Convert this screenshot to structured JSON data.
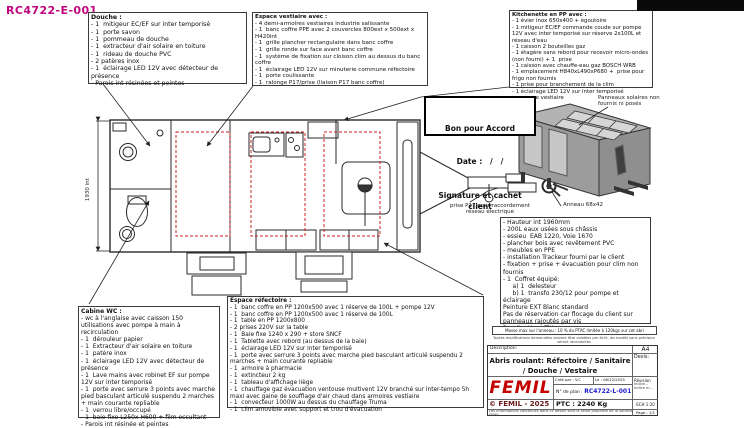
{
  "sheet_ref": "RC4722-E-001",
  "colors": {
    "ref_magenta": "#c0067c",
    "plan_number_blue": "#1a1acc",
    "logo_red": "#c40000",
    "copyright_red": "#6b1a1a",
    "highlight_red_dash": "#cc2222",
    "trailer_gray": "#9c9c9c"
  },
  "panels": {
    "douche": {
      "title": "Douche :",
      "items": [
        "- 1  mitigeur EC/EF sur inter temporisé",
        "- 1  porte savon",
        "- 1  pommeau de douche",
        "- 1  extracteur d'air solaire en toiture",
        "- 1  rideau de douche PVC",
        "- 2 patères inox",
        "- 1  éclairage LED 12V avec détecteur de présence",
        "- Parois int résinées et peintes"
      ]
    },
    "vestiaire": {
      "title": "Espace vestiaire avec :",
      "items": [
        "- 4 demi-armoires vestiaires industrie salissante",
        "- 1  banc coffre PPE avec 2 couvercles 800ext x 500ext x H420int",
        "- 1  grille plancher rectangulaire dans banc coffre",
        "- 1  grille ronde sur face avant banc coffre",
        "- 1  système de fixation sur cloison clim au dessus du banc coffre",
        "- 1  éclairage LED 12V sur minuterie commune réfectoire",
        "- 1  porte coulissante",
        "- 1  ralonge P17/prise (liaison P17 banc coffre)"
      ]
    },
    "kitchenette": {
      "title": "Kitchenette en PP avec :",
      "items": [
        "- 1 évier inox 650x400 + égoutoire",
        "- 1 mitigeur EC/EF commande coude sur pompe 12V avec inter temporisé sur réserve 2x100L et réseau d'eau",
        "- 1 caisson 2 bouteilles gaz",
        "- 1 étagère sans rebord pour recevoir micro-ondes (non fourni) + 1  prise",
        "- 1 caisson avec chauffe-eau gaz BOSCH WRB",
        "- 1 emplacement H840xL490xP680 +  prise pour frigo non fournis",
        "- 1 prise pour branchement de la clim",
        "- 1 éclairage LED 12V sur inter temporisé commune vestiaire"
      ]
    },
    "cabine_wc": {
      "title": "Cabine WC :",
      "items": [
        "- wc à l'anglaise avec caisson 150 utilisations avec pompe à main à recirculation",
        "- 1  dérouleur papier",
        "- 1  Extracteur d'air solaire en toiture",
        "- 1  patère inox",
        "- 1  éclairage LED 12V avec détecteur de présence",
        "- 1  Lave mains avec robinet EF sur pompe 12V sur inter temporisé",
        "- 1  porte avec serrure 3 points avec marche pied basculant articulé suspendu 2 marches + main courante repliable",
        "- 1  verrou libre/occupé",
        "- 1  baie fixe L250x H600 + film occultant",
        "- Parois int résinée et peintes"
      ]
    },
    "refectoire": {
      "title": "Espace réfectoire :",
      "items": [
        "- 1  banc coffre en PP 1200x500 avec 1 réserve de 100L + pompe 12V",
        "- 1  banc coffre en PP 1200x500 avec 1 réserve de 100L",
        "- 1  table en PP 1200x800",
        "- 2 prises 220V sur la table",
        "- 1  Baie fixe 1240 x 290 + store SNCF",
        "- 1  Tablette avec rebord (au dessus de la baie)",
        "- 1  éclairage LED 12V sur inter temporisé",
        "- 1  porte avec serrure 3 points avec marche pied basculant articulé suspendu 2 marches + main courante repliable",
        "- 1  armoire à pharmacie",
        "- 1  extincteur 2 kg",
        "- 1  tableau d'affichage liège",
        "- 1  chauffage gaz évacuation ventouse multivent 12V branché sur inter-tempo 5h maxi avec gaine de soufflage d'air chaud dans armoires vestiaire",
        "- 1  convecteur 1000W au dessus du chauffage Truma",
        "- 1  clim amovible avec support et trou d'évacuation"
      ]
    },
    "specs": {
      "items": [
        "- Hauteur int 1960mm",
        "- 200L eaux usées sous châssis",
        "- essieu  EAB 1220, Voie 1670",
        "- plancher bois avec revêtement PVC",
        "- meubles en PPE",
        "- installation Trackeur fourni par le client",
        "- fixation + prise + évacuation pour clim non fournis",
        "- 1  Coffret équipé:",
        "     a) 1  delesteur",
        "     b) 1  transfo 230/12 pour pompe et éclairage",
        "Peinture EXT Blanc standard",
        "Pas de réservation car flocage du client sur panneaux rajoutés par vis",
        "Pas d'anti graffiti"
      ]
    }
  },
  "approval_box": {
    "line1": "Bon pour Accord",
    "line2": "Date :   /   /",
    "line3": "Signature et cachet client"
  },
  "annotations": {
    "solar_panels": "Panneaux solaires non fournis ni posés",
    "ring": "Anneau 68x42",
    "p17_plug": "prise P17  pour raccordement réseau électrique",
    "interior_height_dim": "1930 int"
  },
  "strips": {
    "masse_note": "Masse max sur l'anneau : 10 % du PTAC limitée à 120kgs sur cet abri",
    "fine_print": "Toutes modifications demandées doivent être validées par écrit, les modifs sans précision seront reconduites"
  },
  "title_block": {
    "description_label": "Description:",
    "description": "Abris roulant: Réfectoire / Sanitaire / Douche / Vestaire",
    "format": "A4",
    "devis_label": "Devis:",
    "logo": "FEMIL",
    "created_by": "Créé par : V.C",
    "date": "Le : 06/12/2025",
    "revision_label": "Révision",
    "revision_line1": "Indice...",
    "revision_line2": "Indice m...",
    "plan_label": "N° de plan : ",
    "plan_number": "RC4722-L-001",
    "copyright": "© FEMIL - 2025",
    "ptc": "PTC : 2240 Kg",
    "scale": "ECH 1:20",
    "legal": "Les informations contenues dans ce dessin sont la seule propriété de la société FEMIL",
    "page": "Page : 1/1"
  }
}
